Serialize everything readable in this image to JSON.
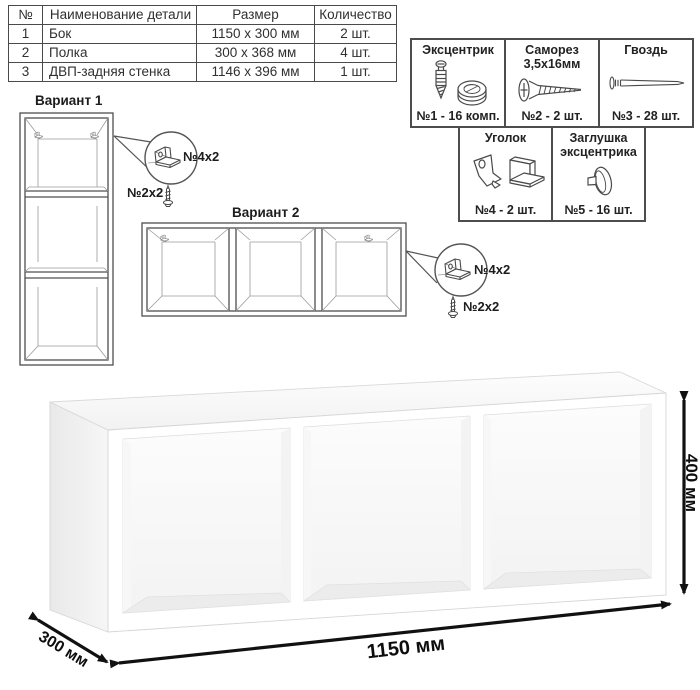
{
  "parts_table": {
    "headers": {
      "num": "№",
      "name": "Наименование детали",
      "size": "Размер",
      "qty": "Количество"
    },
    "rows": [
      {
        "num": "1",
        "name": "Бок",
        "size": "1150 x 300 мм",
        "qty": "2 шт."
      },
      {
        "num": "2",
        "name": "Полка",
        "size": "300 x 368 мм",
        "qty": "4 шт."
      },
      {
        "num": "3",
        "name": "ДВП-задняя стенка",
        "size": "1146 x 396 мм",
        "qty": "1 шт."
      }
    ]
  },
  "hardware": {
    "items": [
      {
        "title": "Эксцентрик",
        "qty": "№1 - 16 комп.",
        "icon": "eccentric-cam"
      },
      {
        "title": "Саморез 3,5х16мм",
        "qty": "№2 - 2 шт.",
        "icon": "screw"
      },
      {
        "title": "Гвоздь",
        "qty": "№3 - 28 шт.",
        "icon": "nail"
      },
      {
        "title": "Уголок",
        "qty": "№4 - 2 шт.",
        "icon": "corner-bracket"
      },
      {
        "title": "Заглушка эксцентрика",
        "qty": "№5 - 16 шт.",
        "icon": "cam-cap"
      }
    ]
  },
  "variant1": {
    "title": "Вариант 1",
    "bracket_label": "№4х2",
    "screw_label": "№2х2"
  },
  "variant2": {
    "title": "Вариант 2",
    "bracket_label": "№4х2",
    "screw_label": "№2х2"
  },
  "dimensions": {
    "width": "1150 мм",
    "height": "400 мм",
    "depth": "300 мм"
  },
  "colors": {
    "line": "#4f4f4f",
    "faint_line": "#9a9a9a",
    "dim_arrow": "#111111",
    "border": "#4d4d4d"
  }
}
